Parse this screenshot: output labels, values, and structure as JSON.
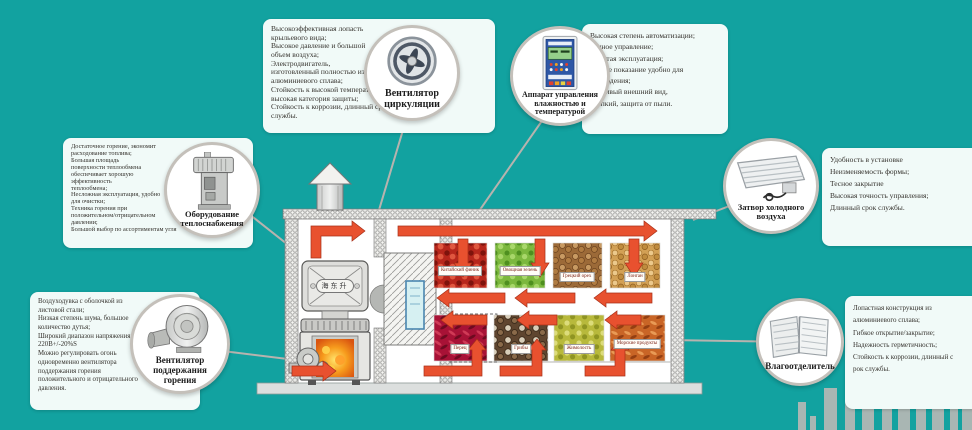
{
  "colors": {
    "background": "#12a2a0",
    "box_background": "#f1faf8",
    "circle_border": "#c4c0ba",
    "arrow_red": "#e8512f",
    "skyline_gray": "#a9b6b3"
  },
  "callouts": {
    "circulation_fan": {
      "label": "Вентилятор\nциркуляции",
      "features": "Высокоэффективная лопасть\nкрыльевого вида;\nВысокое давление и большой\nобъем воздуха;\nЭлектродвигатель,\nизготовленный полностью из\nалюминиевого сплава;\nСтойкость к высокой температуре,\nвысокая категория защиты;\nСтойкость к коррозии, длинный срок\nслужбы."
    },
    "control_unit": {
      "label": "Аппарат управления\nвлажностью и\nтемпературой",
      "features": "Высокая степень автоматизации;\nТочное управление;\nПростая эксплуатация;\nЧеткое показание удобно для\nнаблюдения;\nКрасивый внешний вид,\nкрепкий, защита от пыли."
    },
    "heat_supply": {
      "label": "Оборудование\nтеплоснабжения",
      "features": "Достаточное горение, экономит\nрасходование топлива;\nБольшая площадь\nповерхности теплообмена\nобеспечивает хорошую\nэффективность\nтеплообмена;\nНесложная эксплуатация, удобно\nдля очистки;\nТехника горения при\nположительном/отрицательном\nдавлении;\nБольшой выбор по ассортиментам угля"
    },
    "combustion_fan": {
      "label": "Вентилятор\nподдержания\nгорения",
      "features": "Воздуходувка с оболочкой из\nлистовой стали;\nНизкая степень шума, большое\nколичество дутья;\nШирокий диапазон напряжения\n220В+/-20%S\nМожно регулировать огонь\nодновременно вентилятора\nподдержания горения\nположительного и отрицательного\nдавления."
    },
    "cold_air_valve": {
      "label": "Затвор холодного\nвоздуха",
      "features": "Удобность в установке\nНеизменяемость формы;\nТесное закрытие\nВысокая точность управления;\nДлинный срок службы."
    },
    "moisture_separator": {
      "label": "Влагоотделитель",
      "features": "Лопастная конструкция из\nалюминиевого сплава;\nГибкое открытие/закрытие;\nНадежность герметичность;\nСтойкость к коррозии, длинный с\nрок службы."
    }
  },
  "diagram": {
    "stove_brand": "海东升",
    "products_row1": [
      "Китайский финик",
      "Овощная зелень",
      "Грецкий орех",
      "Лонган"
    ],
    "products_row2": [
      "Перец",
      "Грибы",
      "Жимолость",
      "Морские продукты"
    ]
  }
}
